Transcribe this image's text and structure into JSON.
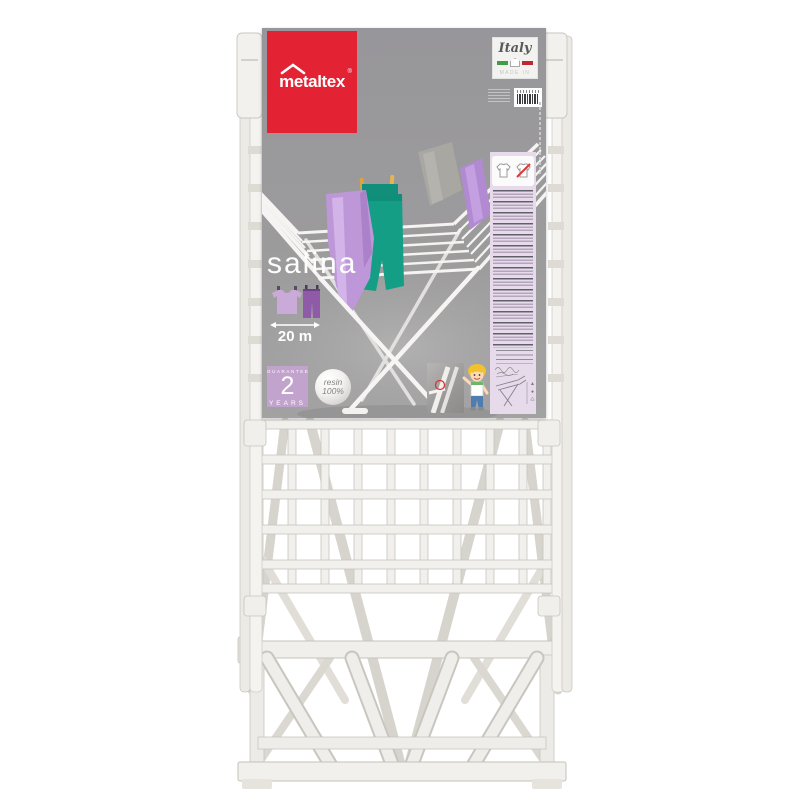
{
  "scene": {
    "background": "#ffffff",
    "subject": "Folded white resin clothes drying rack with cardboard sleeve label"
  },
  "brand": {
    "name": "metaltex",
    "registered_mark": "®",
    "logo_bg": "#e32233",
    "logo_text_color": "#ffffff"
  },
  "origin_badge": {
    "country": "Italy",
    "made_in": "MADE IN",
    "flag_colors": [
      "#3f9e44",
      "#ffffff",
      "#c22630"
    ]
  },
  "product": {
    "name": "salina",
    "drying_length": "20 m"
  },
  "guarantee_badge": {
    "heading": "GUARANTEE",
    "number": "2",
    "unit": "YEARS",
    "bg": "#c2a3cd",
    "text_color": "#ffffff"
  },
  "material_badge": {
    "line1": "resin",
    "line2": "100%",
    "text_color": "#83827f"
  },
  "label": {
    "bg": "#9c9b9c",
    "instruction_panel_bg": "#e7dbeb"
  },
  "photo_colors": {
    "teal_garment": "#149e86",
    "lilac_towel": "#bd97d8",
    "grey_towel": "#a9a7a2",
    "purple_towel": "#b28ad2",
    "clothespin": "#e0a33c",
    "rack_white": "#f5f4f2"
  },
  "rack_colors": {
    "plastic": "#f1f0ec",
    "edge_shadow": "#c8c5bf",
    "legs_behind": "#d7d4cd"
  }
}
